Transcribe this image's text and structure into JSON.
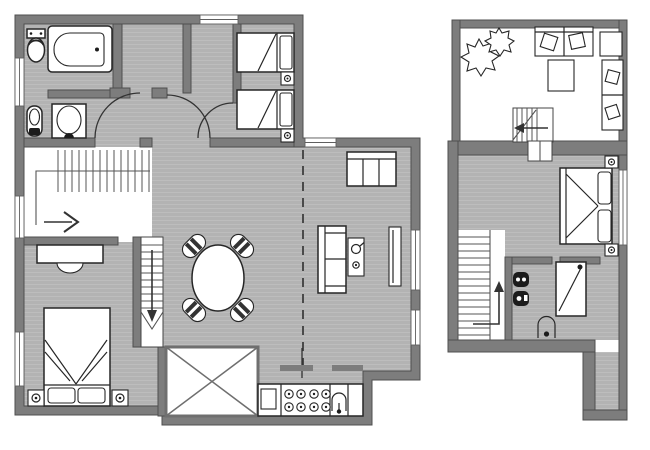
{
  "document": {
    "type": "architectural floor plan drawing",
    "visible_text_labels": [],
    "plan_count": 2
  },
  "colors": {
    "paper": "#ffffff",
    "wall": "#7d7d7d",
    "wall_edge": "#4f4f4f",
    "floor": "#b3b3b3",
    "floor_highlight": "#bdbdbd",
    "line": "#262626",
    "fixture": "#1c1c1c",
    "window_frame": "#5f5f5f",
    "divider_dash": "#4a4a4a",
    "void_border": "#6f6f6f"
  },
  "plans": {
    "main_floor": {
      "name": "main floor plan (left)",
      "rooms": [
        {
          "name": "bathroom",
          "furniture": [
            "toilet",
            "bathtub",
            "bidet",
            "washbasin"
          ]
        },
        {
          "name": "entry-hall",
          "furniture": [
            "door-swing",
            "door-swing",
            "door-swing"
          ]
        },
        {
          "name": "kids-bedroom",
          "furniture": [
            "single-bed",
            "single-bed",
            "nightstand",
            "nightstand"
          ]
        },
        {
          "name": "stair-hall",
          "furniture": [
            "staircase",
            "direction-arrow"
          ]
        },
        {
          "name": "master-bedroom",
          "furniture": [
            "double-bed",
            "nightstand",
            "nightstand",
            "desk",
            "chair"
          ]
        },
        {
          "name": "dining-area",
          "furniture": [
            "round-table",
            "chair",
            "chair",
            "chair",
            "chair"
          ]
        },
        {
          "name": "living-area",
          "furniture": [
            "sofa",
            "loveseat",
            "side-table",
            "radiator"
          ]
        },
        {
          "name": "kitchen",
          "furniture": [
            "counter",
            "cooktop",
            "sink",
            "cabinets",
            "dashed-divider"
          ]
        },
        {
          "name": "void-skylight",
          "furniture": [
            "crossed-square"
          ]
        },
        {
          "name": "staircase-down",
          "furniture": [
            "treads",
            "down-arrow",
            "break-line"
          ]
        }
      ],
      "window_count": 7
    },
    "upper_floor": {
      "name": "upper floor plan (right)",
      "rooms": [
        {
          "name": "roof-terrace",
          "furniture": [
            "plants",
            "outdoor-sofa",
            "corner-table",
            "coffee-table",
            "lounge-chair",
            "lounge-chair",
            "staircase"
          ]
        },
        {
          "name": "bedroom",
          "furniture": [
            "double-bed",
            "nightstand",
            "nightstand"
          ]
        },
        {
          "name": "bathroom",
          "furniture": [
            "toilet",
            "bidet",
            "shower",
            "washbasin"
          ]
        },
        {
          "name": "stair-hall",
          "furniture": [
            "staircase",
            "up-arrow"
          ]
        },
        {
          "name": "side-corridor",
          "furniture": []
        }
      ],
      "window_count": 1
    }
  }
}
